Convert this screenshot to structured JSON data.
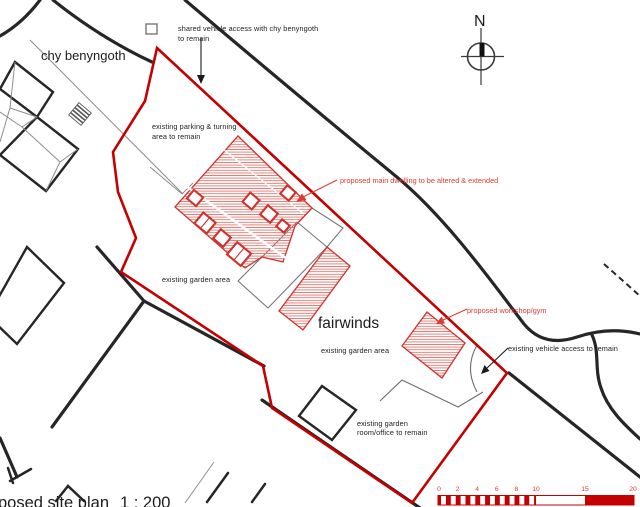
{
  "drawing_title": {
    "text_visible": "posed site plan",
    "scale_ratio": "1 : 200"
  },
  "labels": {
    "neighbor_house": "chy benyngoth",
    "site_name": "fairwinds",
    "shared_access_line1": "shared vehicle access with chy benyngoth",
    "shared_access_line2": "to remain",
    "parking_line1": "existing parking & turning",
    "parking_line2": "area to remain",
    "main_dwelling": "proposed main dwelling to be altered & extended",
    "garden_area_west": "existing garden area",
    "garden_area_south": "existing garden area",
    "workshop": "proposed workshop/gym",
    "vehicle_access": "existing vehicle access to remain",
    "garden_room_line1": "existing garden",
    "garden_room_line2": "room/office to remain"
  },
  "north_indicator": {
    "letter": "N"
  },
  "scale_bar": {
    "ticks": [
      "0",
      "2",
      "4",
      "6",
      "8",
      "10",
      "15",
      "20"
    ],
    "units_metres_total": 20,
    "striped_span": "0-10 alternating 0.5m",
    "solid_span": "15-20"
  },
  "colors": {
    "boundary_red": "#c40000",
    "hatch_red": "#e4736c",
    "annotation_red": "#e03a30",
    "draw_black": "#262626",
    "gray": "#8d8d8d"
  }
}
